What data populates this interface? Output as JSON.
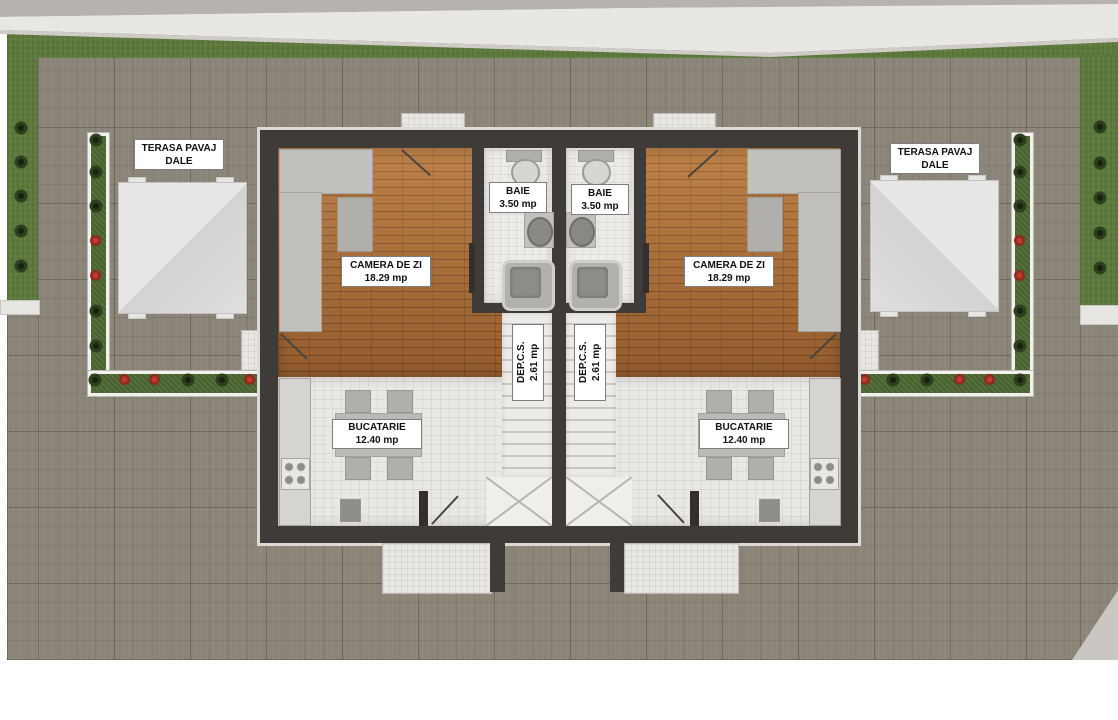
{
  "labels": {
    "terrace_left": {
      "line1": "TERASA PAVAJ",
      "line2": "DALE"
    },
    "terrace_right": {
      "line1": "TERASA PAVAJ",
      "line2": "DALE"
    },
    "living_left": {
      "name": "CAMERA DE ZI",
      "area": "18.29 mp"
    },
    "living_right": {
      "name": "CAMERA DE ZI",
      "area": "18.29 mp"
    },
    "bath_left": {
      "name": "BAIE",
      "area": "3.50 mp"
    },
    "bath_right": {
      "name": "BAIE",
      "area": "3.50 mp"
    },
    "kitchen_left": {
      "name": "BUCATARIE",
      "area": "12.40 mp"
    },
    "kitchen_right": {
      "name": "BUCATARIE",
      "area": "12.40 mp"
    },
    "storage_left": {
      "name": "DEP.C.S.",
      "area": "2.61 mp"
    },
    "storage_right": {
      "name": "DEP.C.S.",
      "area": "2.61 mp"
    }
  },
  "colors": {
    "page_bg": "#ffffff",
    "grass": "#5e7a3c",
    "pavement": "#8b8478",
    "wall_dark": "#3e3b38",
    "wood_floor": "#b1713a",
    "tile_light": "#eae8e4",
    "planter_hedge": "#55703a",
    "flower_red": "#c03a2c",
    "boundary_wall": "#e9e7e4",
    "label_bg": "#ffffff",
    "label_text": "#111111"
  }
}
